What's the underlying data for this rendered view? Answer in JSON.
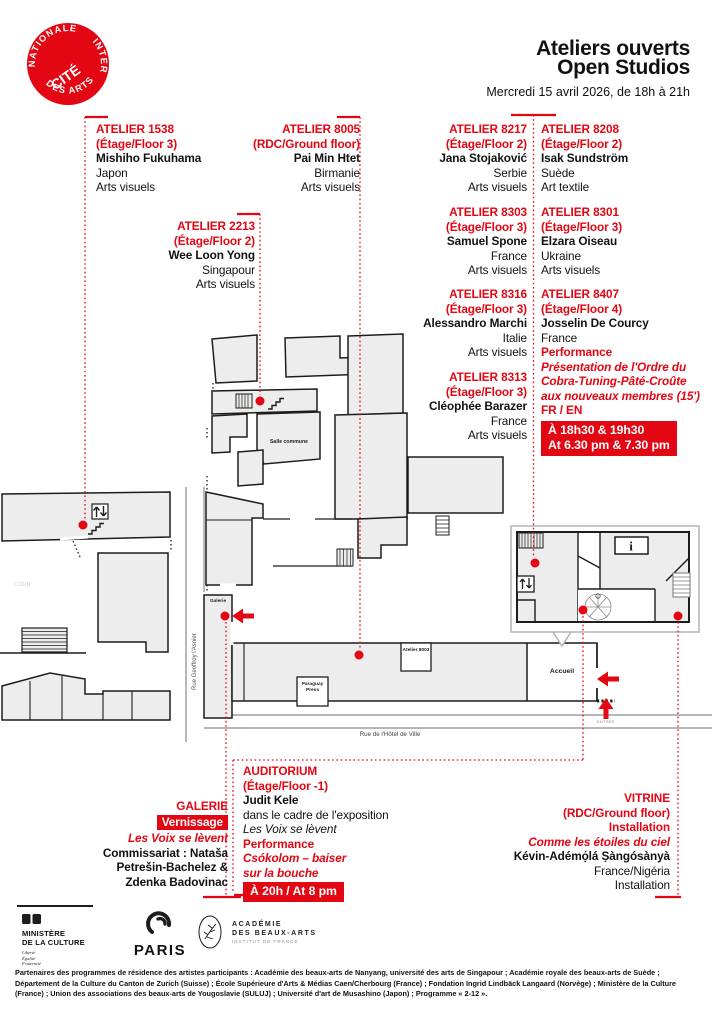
{
  "logo": {
    "center": "CITÉ",
    "arc_top": "NATIONALE",
    "arc_right": "INTER",
    "arc_bottom": "DES ARTS"
  },
  "header": {
    "title_line1": "Ateliers ouverts",
    "title_line2": "Open Studios",
    "date": "Mercredi 15 avril 2026, de 18h à 21h"
  },
  "colors": {
    "accent_red": "#e30613",
    "map_fill": "#ededed",
    "map_line": "#1d1d1b"
  },
  "icons": {
    "info": "i"
  },
  "studios": [
    {
      "number": "ATELIER 1538",
      "floor": "(Étage/Floor 3)",
      "artist": "Mishiho Fukuhama",
      "country": "Japon",
      "discipline": "Arts visuels"
    },
    {
      "number": "ATELIER 8005",
      "floor": "(RDC/Ground floor)",
      "artist": "Pai Min Htet",
      "country": "Birmanie",
      "discipline": "Arts visuels"
    },
    {
      "number": "ATELIER 2213",
      "floor": "(Étage/Floor 2)",
      "artist": "Wee Loon Yong",
      "country": "Singapour",
      "discipline": "Arts visuels"
    },
    {
      "number": "ATELIER 8217",
      "floor": "(Étage/Floor 2)",
      "artist": "Jana Stojaković",
      "country": "Serbie",
      "discipline": "Arts visuels"
    },
    {
      "number": "ATELIER 8208",
      "floor": "(Étage/Floor 2)",
      "artist": "Isak Sundström",
      "country": "Suède",
      "discipline": "Art textile"
    },
    {
      "number": "ATELIER 8303",
      "floor": "(Étage/Floor 3)",
      "artist": "Samuel Spone",
      "country": "France",
      "discipline": "Arts visuels"
    },
    {
      "number": "ATELIER 8301",
      "floor": "(Étage/Floor 3)",
      "artist": "Elzara Oiseau",
      "country": "Ukraine",
      "discipline": "Arts visuels"
    },
    {
      "number": "ATELIER 8316",
      "floor": "(Étage/Floor 3)",
      "artist": "Alessandro Marchi",
      "country": "Italie",
      "discipline": "Arts visuels"
    },
    {
      "number": "ATELIER 8407",
      "floor": "(Étage/Floor 4)",
      "artist": "Josselin De Courcy",
      "country": "France",
      "performance_label": "Performance",
      "performance_title_lines": [
        "Présentation de l'Ordre du",
        "Cobra-Tuning-Pâté-Croûte",
        "aux nouveaux membres (15')"
      ],
      "languages": "FR / EN",
      "time_fr": "À 18h30 & 19h30",
      "time_en": "At 6.30 pm & 7.30 pm"
    },
    {
      "number": "ATELIER 8313",
      "floor": "(Étage/Floor 3)",
      "artist": "Cléophée Barazer",
      "country": "France",
      "discipline": "Arts visuels"
    }
  ],
  "venues": {
    "galerie": {
      "name": "GALERIE",
      "badge": "Vernissage",
      "title": "Les Voix se lèvent",
      "curator_lines": [
        "Commissariat : Nataša",
        "Petrešin-Bachelez &",
        "Zdenka Badovinac"
      ]
    },
    "auditorium": {
      "name": "AUDITORIUM",
      "floor": "(Étage/Floor -1)",
      "artist": "Judit Kele",
      "context": "dans le cadre de l'exposition",
      "exhibition": "Les Voix se lèvent",
      "performance_label": "Performance",
      "performance_title_lines": [
        "Csókolom – baiser",
        "sur la bouche"
      ],
      "time": "À 20h / At 8 pm"
    },
    "vitrine": {
      "name": "VITRINE",
      "floor": "(RDC/Ground floor)",
      "type": "Installation",
      "title": "Comme les étoiles du ciel",
      "artist": "Kévin-Adémọ́lá Ṣàngósànyà",
      "country": "France/Nigéria",
      "discipline": "Installation"
    }
  },
  "map": {
    "labels": {
      "cour": "COUR",
      "salle_commune": "Salle commune",
      "galerie": "Galerie",
      "paraguay_press": "Paraguay Press",
      "atelier_8003": "Atelier 8003",
      "accueil": "Accueil",
      "entree": "ENTRÉE",
      "rue_geoffroy": "Rue Geoffroy l'Asnier",
      "rue_hotel": "Rue de l'Hôtel de Ville"
    }
  },
  "footer": {
    "ministere": {
      "line1": "MINISTÈRE",
      "line2": "DE LA CULTURE",
      "motto": [
        "Liberté",
        "Égalité",
        "Fraternité"
      ]
    },
    "paris": {
      "label": "PARIS"
    },
    "academie": {
      "line1": "ACADÉMIE",
      "line2": "DES BEAUX-ARTS",
      "line3": "INSTITUT DE FRANCE"
    },
    "partners_lines": [
      "Partenaires des programmes de résidence des artistes participants : Académie des beaux-arts de Nanyang, université des arts de Singapour ; Académie royale des beaux-arts de Suède ;",
      "Département de la Culture du Canton de Zurich (Suisse) ; École Supérieure d'Arts & Médias Caen/Cherbourg (France) ; Fondation Ingrid Lindbäck Langaard (Norvège) ; Ministère de la Culture",
      "(France) ; Union des associations des beaux-arts de Yougoslavie (SULUJ) ; Université d'art de Musashino (Japon) ; Programme « 2-12 »."
    ]
  }
}
